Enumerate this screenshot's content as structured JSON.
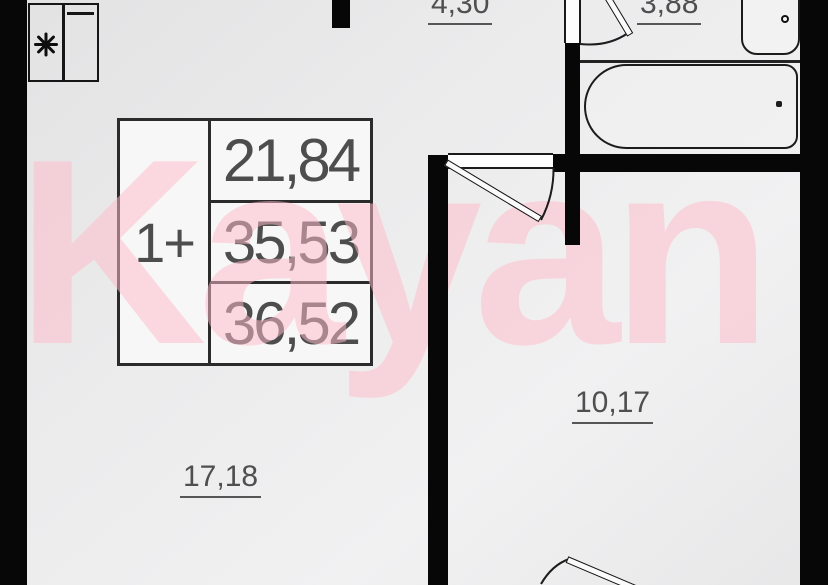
{
  "watermark": {
    "text": "Kayan"
  },
  "unit_card": {
    "type_label": "1+",
    "areas": [
      "21,84",
      "35,53",
      "36,52"
    ]
  },
  "rooms": {
    "hallway_area": "4,30",
    "bathroom_area": "3,88",
    "living_room_area": "17,18",
    "bedroom_area": "10,17"
  },
  "palette": {
    "wall_black": "#070707",
    "dimension_text_gray": "#4d4d4d",
    "watermark_pink": "#f6ccd6",
    "floor_gray": "#ececec"
  }
}
